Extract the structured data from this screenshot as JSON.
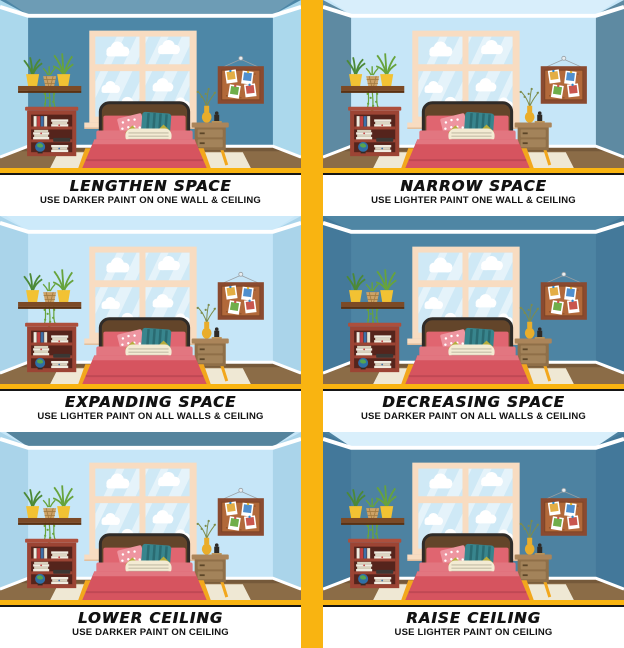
{
  "poster": {
    "background": "#ffffff",
    "divider_color": "#F9B411",
    "text_color": "#121212",
    "caption_rule_color": "#161616"
  },
  "panels": [
    {
      "id": "lengthen-space",
      "title": "LENGTHEN SPACE",
      "subtitle": "USE DARKER PAINT ON ONE WALL & CEILING",
      "room": {
        "ceiling": "#6D9CB5",
        "wall": "#4D87A7",
        "side": "#ABD8EC"
      }
    },
    {
      "id": "narrow-space",
      "title": "NARROW SPACE",
      "subtitle": "USE LIGHTER PAINT ONE WALL & CEILING",
      "room": {
        "ceiling": "#D8EEFB",
        "wall": "#C6E6F8",
        "side": "#5E8AA2"
      }
    },
    {
      "id": "expanding-space",
      "title": "EXPANDING SPACE",
      "subtitle": "USE LIGHTER PAINT ON ALL WALLS & CEILING",
      "room": {
        "ceiling": "#CDEAFA",
        "wall": "#C6E6F8",
        "side": "#AAD4EA"
      }
    },
    {
      "id": "decreasing-space",
      "title": "DECREASING SPACE",
      "subtitle": "USE DARKER PAINT ON ALL WALLS & CEILING",
      "room": {
        "ceiling": "#4F86A4",
        "wall": "#4D84A3",
        "side": "#44799A"
      }
    },
    {
      "id": "lower-ceiling",
      "title": "LOWER CEILING",
      "subtitle": "USE DARKER PAINT ON CEILING",
      "room": {
        "ceiling": "#55849D",
        "wall": "#C6E6F8",
        "side": "#AAD4EA"
      }
    },
    {
      "id": "raise-ceiling",
      "title": "RAISE CEILING",
      "subtitle": "USE LIGHTER PAINT ON CEILING",
      "room": {
        "ceiling": "#D9EFFB",
        "wall": "#4D82A1",
        "side": "#43789A"
      }
    }
  ],
  "scene_palette": {
    "molding": "#ffffff",
    "frame": "#F8DCC1",
    "frame_shadow": "#E4BE9C",
    "pane": "#CFE9F6",
    "cloud": "#ffffff",
    "floor": "#8B6C47",
    "floor_dark": "#75593A",
    "rug": "#EFE8D4",
    "headboard": "#63452A",
    "headboard_edge": "#2F2B28",
    "mattress": "#E27680",
    "blanket": "#D6545F",
    "blanket_dark": "#C04854",
    "leg": "#F2A71D",
    "pillow_pink": "#E06570",
    "pillow_dot": "#EE95A0",
    "pillow_teal": "#38858D",
    "pillow_teal_dark": "#2A6B72",
    "pillow_cream": "#F3EBD3",
    "pillow_cream_stripe": "#C3BCA6",
    "accent": "#B6AD3C",
    "shelf": "#7C4A26",
    "shelf_dark": "#5A3112",
    "pot": "#F2C233",
    "plant": "#67A33C",
    "plant_dark": "#4C8937",
    "basket": "#CDA266",
    "basket_line": "#A37B40",
    "bookshelf": "#9C4434",
    "bookshelf_light": "#AD4F3C",
    "bookshelf_dark": "#55241C",
    "nightstand": "#8F6F48",
    "nightstand_top": "#AB855A",
    "nightstand_drawer": "#A3835A",
    "cork": "#B2693A",
    "cork_frame": "#8A4A30",
    "vase": "#E9AD2B",
    "ink": "#2E2A26"
  }
}
